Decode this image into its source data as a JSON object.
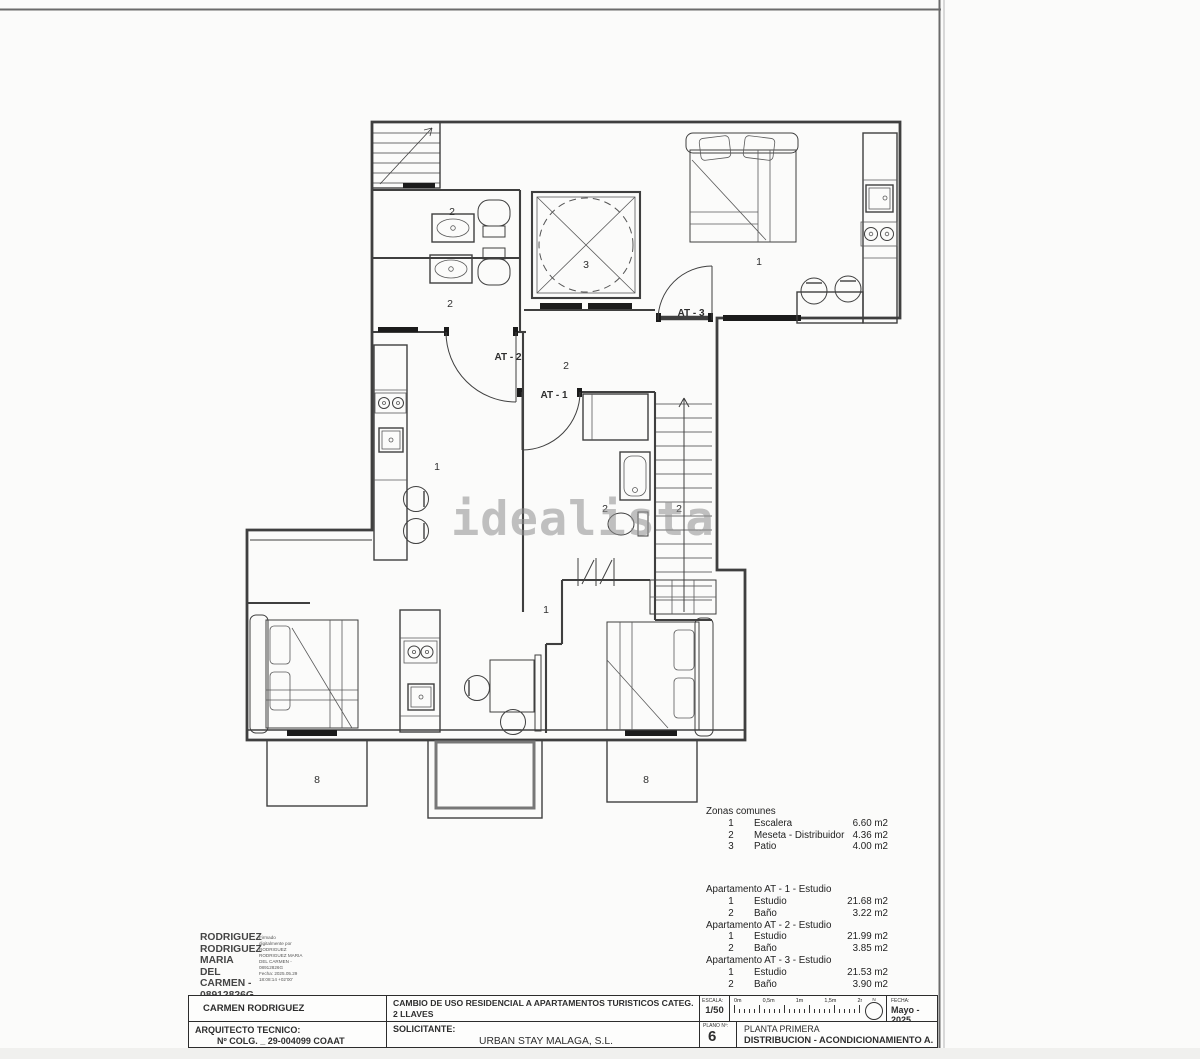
{
  "watermark": {
    "text": "idealista",
    "color": "#8f8f8f"
  },
  "plan": {
    "labels": {
      "bath_top": "2",
      "bath_bottom": "2",
      "patio": "3",
      "at3_room": "1",
      "at3_door": "AT - 3",
      "at2_door": "AT - 2",
      "meseta": "2",
      "at1_door": "AT - 1",
      "at2_room": "1",
      "at1_bath": "2",
      "stairs_zone": "2",
      "at1_room": "1",
      "balcony_left": "8",
      "balcony_right": "8"
    }
  },
  "legend": {
    "zonas_title": "Zonas comunes",
    "zonas": [
      {
        "num": "1",
        "name": "Escalera",
        "area": "6.60 m2"
      },
      {
        "num": "2",
        "name": "Meseta - Distribuidor",
        "area": "4.36 m2"
      },
      {
        "num": "3",
        "name": "Patio",
        "area": "4.00 m2"
      }
    ],
    "apartments": [
      {
        "title": "Apartamento AT - 1 - Estudio",
        "rows": [
          {
            "num": "1",
            "name": "Estudio",
            "area": "21.68 m2"
          },
          {
            "num": "2",
            "name": "Baño",
            "area": "3.22 m2"
          }
        ]
      },
      {
        "title": "Apartamento AT - 2 - Estudio",
        "rows": [
          {
            "num": "1",
            "name": "Estudio",
            "area": "21.99 m2"
          },
          {
            "num": "2",
            "name": "Baño",
            "area": "3.85 m2"
          }
        ]
      },
      {
        "title": "Apartamento AT - 3 - Estudio",
        "rows": [
          {
            "num": "1",
            "name": "Estudio",
            "area": "21.53 m2"
          },
          {
            "num": "2",
            "name": "Baño",
            "area": "3.90 m2"
          }
        ]
      }
    ]
  },
  "signature": {
    "name_lines": [
      "RODRIGUEZ",
      "RODRIGUEZ",
      "MARIA DEL",
      "CARMEN -",
      "08912826G"
    ],
    "detail_lines": [
      "Firmado",
      "digitalmente por",
      "RODRIGUEZ",
      "RODRIGUEZ MARIA",
      "DEL CARMEN -",
      "08912826G",
      "Fecha: 2025.05.29",
      "18:08:14 +02'00'"
    ]
  },
  "titleblock": {
    "author": "CARMEN RODRIGUEZ",
    "project_line1": "CAMBIO DE USO RESIDENCIAL A APARTAMENTOS TURISTICOS CATEG. 2 LLAVES",
    "project_line2": "CALLE GORDON, Nº 6  MALAGA",
    "escala_label": "ESCALA:",
    "escala_value": "1/50",
    "scale_tick_0": "0m",
    "scale_tick_1": "0,5m",
    "scale_tick_2": "1m",
    "scale_tick_3": "1,5m",
    "scale_tick_4": "2m",
    "north_label": "N",
    "fecha_label": "FECHA:",
    "fecha_value": "Mayo - 2025",
    "arquitecto_label": "ARQUITECTO TECNICO:",
    "arquitecto_value": "Nº COLG. _ 29-004099  COAAT MALAGA",
    "solicitante_label": "SOLICITANTE:",
    "solicitante_value": "URBAN STAY MALAGA, S.L.",
    "plano_label": "PLANO Nº:",
    "plano_value": "6",
    "planta_line1": "PLANTA PRIMERA",
    "planta_line2": "DISTRIBUCION - ACONDICIONAMIENTO A. T. - 2 Llaves"
  }
}
